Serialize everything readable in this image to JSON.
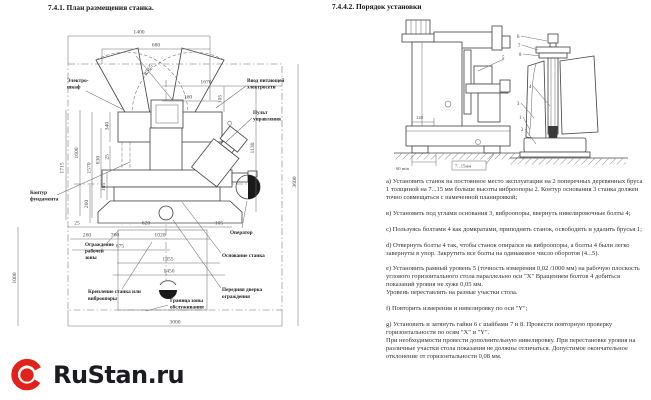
{
  "left": {
    "title": "7.4.1. План размещения станка.",
    "dims": {
      "d1400": "1400",
      "d680": "680",
      "r565": "R565",
      "d1670": "1670",
      "d160": "160",
      "d105a": "105",
      "d340": "340",
      "d25a": "25",
      "d830": "830",
      "d1600": "1600",
      "d1715": "1715",
      "d1570": "1570",
      "d105b": "105",
      "d260a": "260",
      "d25b": "25",
      "d620": "620",
      "d105c": "105",
      "d260b": "260",
      "d760": "760",
      "d1020": "1020",
      "d675": "675",
      "d1355": "1355",
      "d1450": "1450",
      "d1000": "1000",
      "d3000": "3000",
      "d1130": "1130",
      "d3600": "3600"
    },
    "labels": {
      "electro_cabinet": [
        "Электро-",
        "шкаф"
      ],
      "power_input": [
        "Ввод питающей",
        "электросети"
      ],
      "control_panel": [
        "Пульт",
        "управления"
      ],
      "foundation_contour": [
        "Контур",
        "фундамента"
      ],
      "work_zone_guard": [
        "Ограждение",
        "рабочей",
        "зоны"
      ],
      "machine_mount": [
        "Крепление станка или",
        "виброопоры"
      ],
      "service_zone_border": [
        "Граница зоны",
        "обслуживания"
      ],
      "operator": "Оператор",
      "machine_base": "Основание станка",
      "front_guard_door": [
        "Передняя дверка",
        "ограждения"
      ]
    }
  },
  "right": {
    "title": "7.4.4.2. Порядок установки",
    "drawing": {
      "min60": "60 min",
      "mm715": "7...15мм",
      "d120": "120",
      "callouts": [
        "5",
        "6",
        "7",
        "8",
        "4",
        "3",
        "1",
        "2"
      ]
    },
    "paragraphs": [
      "а) Установить станок на постоянное место эксплуатации на 2 поперечных деревянных бруса 1 толщиной на 7...15 мм больше высоты виброопоры 2. Контур основания 3 станка должен точно совмещаться с намеченной планировкой;",
      "в) Установить под углами основания 3, виброопоры, ввернуть нивелировочные болты 4;",
      "с) Пользуясь болтами 4 как домкратами, приподнять станок, освободить и удалить брусья 1;",
      "d) Отвернуть болты 4 так, чтобы станок опирался на виброопоры, а болты 4 были легко завернуты в упор. Закрутить все болты на одинаковое число оборотов (4...5).",
      "е) Установить рамный уровень 5 (точность измерения 0,02 /1000 мм) на рабочую плоскость углового горизонтального стола параллельно оси \"X\" Вращением болтов 4 добиться показаний уровня не хуже 0,05 мм.\nУровень переставлять на разные участки стола.",
      "f) Повторить измерения и нивелировку по оси \"Y\";",
      "g) Установить и затянуть гайки 6 с шайбами 7 и 8. Провести повторную проверку горизонтальности по осям \"X\" и \"Y\".\nПри необходимости провести дополнительную нивелировку. При перестановке уровня на различные участки стола показания не должны отличаться. Допустимое окончательное отклонение от горизонтальности 0,08 мм."
    ]
  },
  "logo": {
    "text": "RuStan.ru",
    "accent_color": "#E3211B"
  }
}
